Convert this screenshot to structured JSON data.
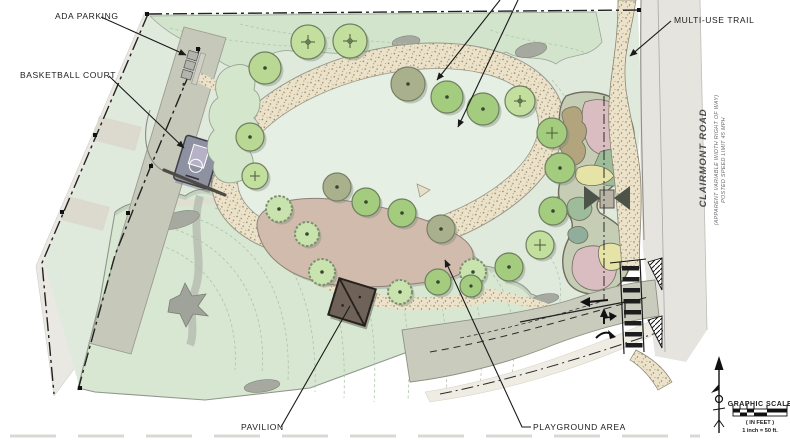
{
  "drawing": {
    "type": "park-master-plan-rendering",
    "labels": {
      "ada_parking": "ADA PARKING",
      "basketball_court": "BASKETBALL COURT",
      "multi_use_trail": "MULTI-USE TRAIL",
      "pavilion": "PAVILION",
      "playground_area": "PLAYGROUND AREA",
      "clairmont_road": "CLAIRMONT ROAD",
      "clairmont_road_sub1": "(APPARENT VARIABLE WIDTH RIGHT OF WAY)",
      "clairmont_road_sub2": "POSTED SPEED LIMIT 45 MPH"
    },
    "graphic_scale": {
      "title": "GRAPHIC SCALE",
      "units": "( IN FEET )",
      "ratio": "1 inch = 50 ft."
    },
    "icons": {
      "north_arrow": "north-arrow",
      "scale_bar": "checkered-scale-bar",
      "crosswalk": "ladder-crosswalk",
      "traffic_arrows": [
        "left-arrow",
        "left-turn-arrow",
        "curve-arrow"
      ]
    },
    "palette": {
      "paper": "#ffffff",
      "meadow_green": "#dfeadd",
      "woodland_green": "#d7e7d1",
      "lawn_green": "#e6efe3",
      "tree_light": "#c2df9e",
      "tree_mid": "#a3cc7f",
      "tree_olive": "#a9b18c",
      "path_tan": "#ebe2c9",
      "playground_tan": "#d0bbac",
      "pavilion_brown": "#6f6259",
      "parking_gray": "#c6c8ba",
      "road_gray": "#e6e4df",
      "court_purple": "#8e91a0",
      "rain_garden_pink": "#d9bdc1",
      "rain_garden_sage": "#9dbd9a",
      "rain_garden_yellow": "#e6e3a6",
      "boundary_ink": "#222222"
    }
  }
}
